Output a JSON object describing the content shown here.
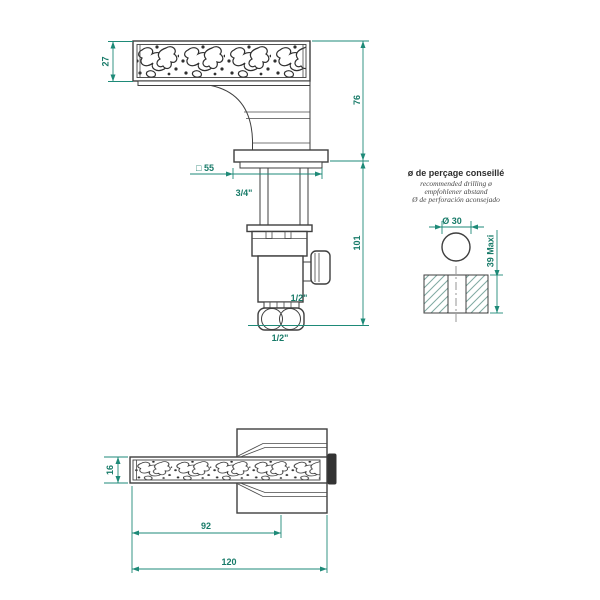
{
  "drawing": {
    "side_view": {
      "dim_spout_height": "27",
      "dim_height_above_deck": "76",
      "dim_height_below_deck": "101",
      "dim_base_square": "□ 55",
      "label_inlet": "3/4\"",
      "label_side_outlet": "1/2\"",
      "label_bottom_outlet": "1/2\""
    },
    "drill_note": {
      "title": "ø de perçage conseillé",
      "subtitle_en": "recommended drilling ø",
      "subtitle_de": "empfohlener abstand",
      "subtitle_es": "Ø de perforación aconsejado",
      "dim_hole_diameter": "Ø 30",
      "dim_max_thickness": "39 Maxi"
    },
    "top_view": {
      "dim_spout_width": "16",
      "dim_spout_reach": "92",
      "dim_total_length": "120"
    }
  },
  "colors": {
    "dimension_accent": "#1e8a78",
    "line": "#3f3f3f"
  }
}
